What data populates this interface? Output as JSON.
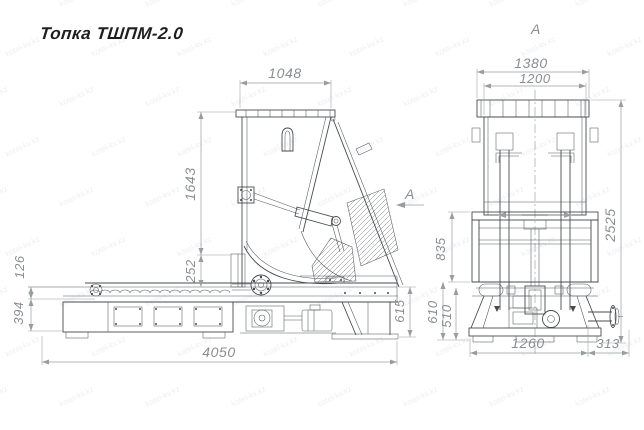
{
  "title": "Топка ТШПМ-2.0",
  "watermark": {
    "text": "kotel-kv.kz"
  },
  "colors": {
    "line": "#474b4f",
    "dimension": "#9a9da0",
    "dimension_text": "#8a8d91",
    "title_text": "#1f1f1f",
    "watermark_text": "#7b84a8",
    "background": "#ffffff"
  },
  "views": {
    "side": {
      "name": "Side elevation",
      "section_arrow_label": "A",
      "dimensions": {
        "hopper_width": "1048",
        "hopper_height": "1643",
        "chute_height": "252",
        "conveyor_step": "126",
        "ash_box_height": "394",
        "total_length": "4050",
        "frame_height": "615"
      }
    },
    "front": {
      "name": "Front view (A)",
      "view_label": "A",
      "dimensions": {
        "overall_width": "1380",
        "hopper_width": "1200",
        "overall_height": "2525",
        "mid_section_height": "835",
        "frame_height_outer": "610",
        "frame_height_inner": "510",
        "base_width": "1260",
        "shaft_length": "313"
      }
    }
  }
}
